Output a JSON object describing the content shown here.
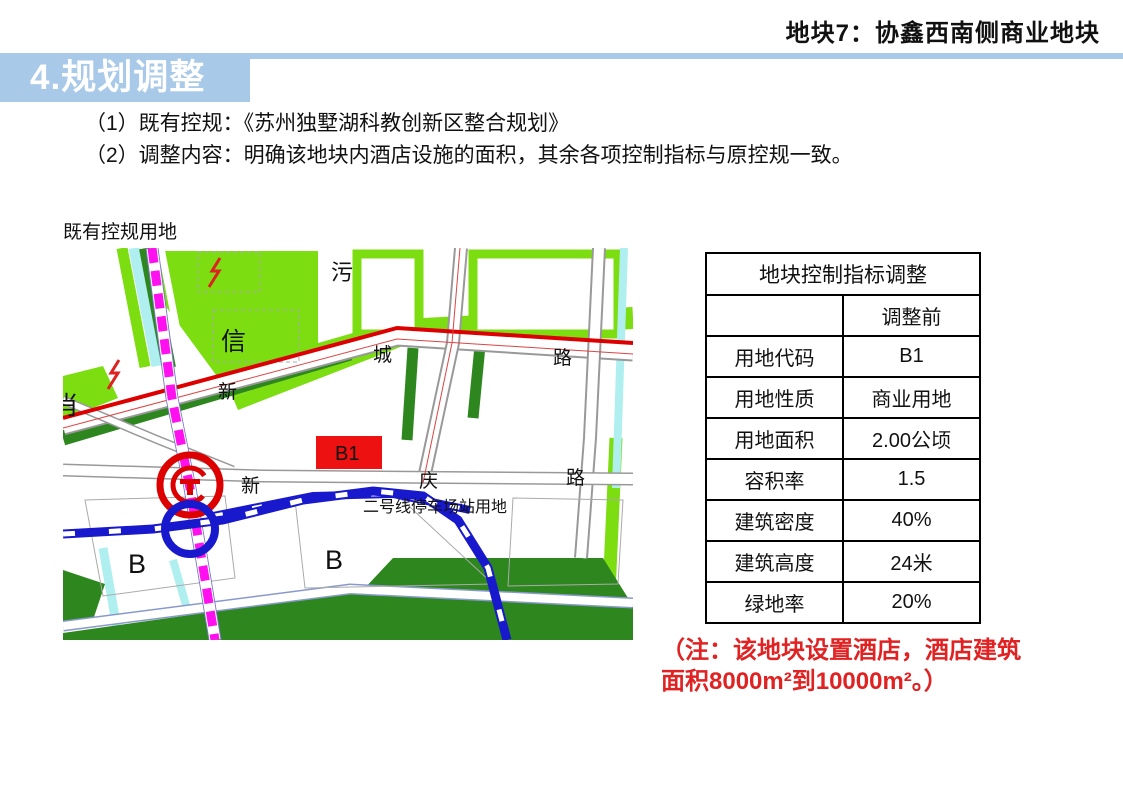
{
  "header": {
    "title": "地块7：协鑫西南侧商业地块"
  },
  "banner": {
    "title": "4.规划调整",
    "color": "#A9C9E9"
  },
  "intro": {
    "line1": "（1）既有控规：《苏州独墅湖科教创新区整合规划》",
    "line2": "（2）调整内容：明确该地块内酒店设施的面积，其余各项控制指标与原控规一致。"
  },
  "map": {
    "caption": "既有控规用地",
    "labels": {
      "wu": "污",
      "xin": "信",
      "xiao": "肖",
      "road_top_1": "新",
      "road_top_2": "城",
      "road_top_3": "路",
      "road_mid_1": "新",
      "road_mid_2": "庆",
      "road_mid_3": "路",
      "b_left": "B",
      "b_right": "B",
      "b1_block": "B1",
      "depot": "二号线停车场站用地"
    },
    "colors": {
      "bright_green": "#7CDD11",
      "dark_green": "#2D871E",
      "cyan": "#AFEFEF",
      "red_line": "#DD0000",
      "magenta_line": "#FF10EE",
      "blue_line": "#1818CC",
      "b1_fill": "#EE1111"
    }
  },
  "table": {
    "title": "地块控制指标调整",
    "col_header": "调整前",
    "rows": [
      [
        "用地代码",
        "B1"
      ],
      [
        "用地性质",
        "商业用地"
      ],
      [
        "用地面积",
        "2.00公顷"
      ],
      [
        "容积率",
        "1.5"
      ],
      [
        "建筑密度",
        "40%"
      ],
      [
        "建筑高度",
        "24米"
      ],
      [
        "绿地率",
        "20%"
      ]
    ]
  },
  "note": {
    "line1": "（注：该地块设置酒店，酒店建筑",
    "line2": "面积8000m²到10000m²。）",
    "color": "#E02222"
  }
}
